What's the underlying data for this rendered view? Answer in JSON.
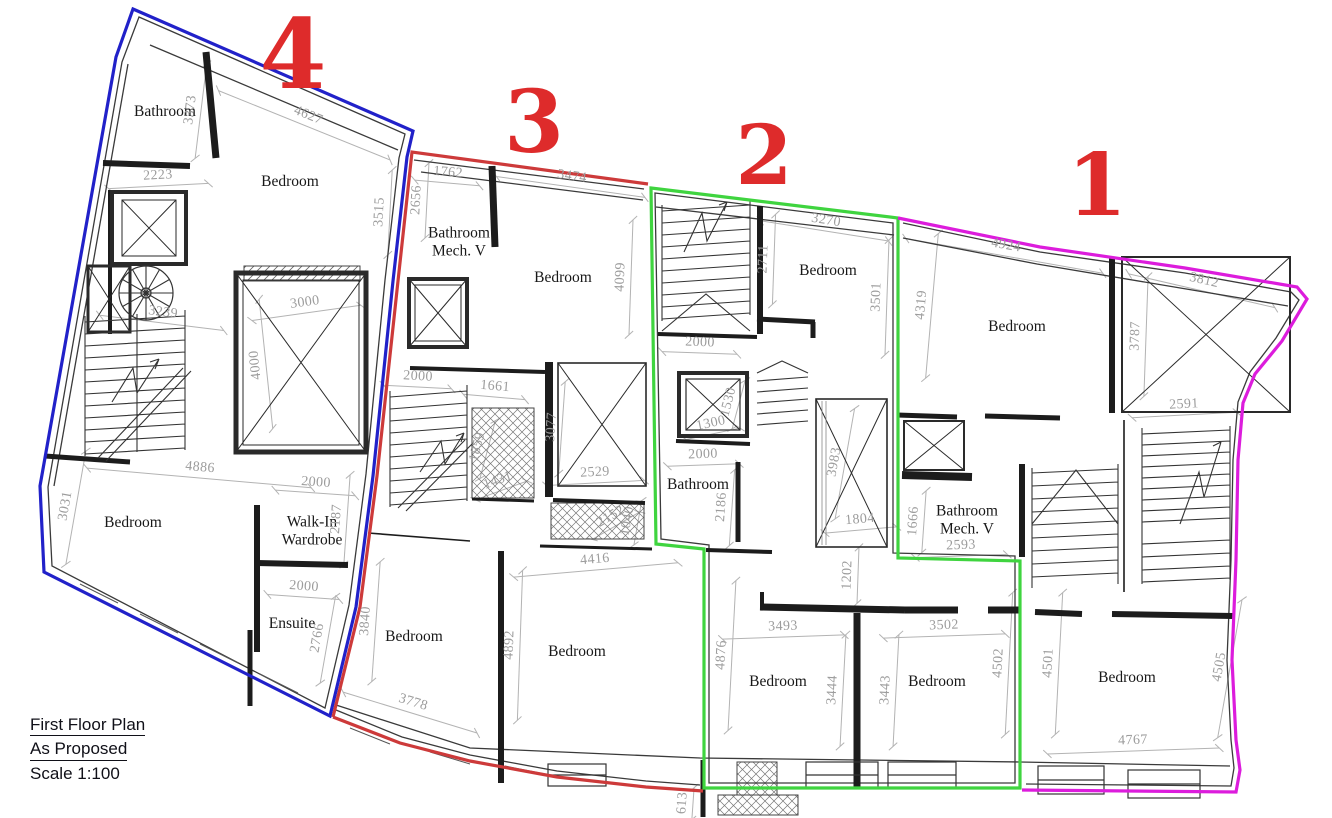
{
  "title_block": {
    "line1": "First Floor Plan",
    "line2": "As Proposed",
    "line3": "Scale 1:100"
  },
  "accent": {
    "unit_number_color": "#de2b2b",
    "dimension_text_color": "#9c9c9c",
    "wall_color": "#1c1c1c",
    "background": "#ffffff"
  },
  "units": [
    {
      "number": "4",
      "outline_color": "#2121c9",
      "label_x": 293,
      "label_y": 55,
      "size": 96
    },
    {
      "number": "3",
      "outline_color": "#cd3a3a",
      "label_x": 534,
      "label_y": 123,
      "size": 86
    },
    {
      "number": "2",
      "outline_color": "#3fd43f",
      "label_x": 764,
      "label_y": 156,
      "size": 82
    },
    {
      "number": "1",
      "outline_color": "#dc1cdc",
      "label_x": 1097,
      "label_y": 186,
      "size": 86
    }
  ],
  "rooms": [
    {
      "name": "Bathroom",
      "x": 165,
      "y": 112
    },
    {
      "name": "Bedroom",
      "x": 290,
      "y": 182
    },
    {
      "name": "Bathroom\nMech. V",
      "x": 459,
      "y": 243
    },
    {
      "name": "Bedroom",
      "x": 563,
      "y": 278
    },
    {
      "name": "Bedroom",
      "x": 828,
      "y": 271
    },
    {
      "name": "Bedroom",
      "x": 1017,
      "y": 327
    },
    {
      "name": "Bathroom",
      "x": 698,
      "y": 485
    },
    {
      "name": "Bathroom\nMech. V",
      "x": 967,
      "y": 521
    },
    {
      "name": "Bedroom",
      "x": 133,
      "y": 523
    },
    {
      "name": "Walk-In\nWardrobe",
      "x": 312,
      "y": 532
    },
    {
      "name": "Ensuite",
      "x": 292,
      "y": 624
    },
    {
      "name": "Bedroom",
      "x": 414,
      "y": 637
    },
    {
      "name": "Bedroom",
      "x": 577,
      "y": 652
    },
    {
      "name": "Bedroom",
      "x": 778,
      "y": 682
    },
    {
      "name": "Bedroom",
      "x": 937,
      "y": 682
    },
    {
      "name": "Bedroom",
      "x": 1127,
      "y": 678
    }
  ],
  "dimensions": [
    {
      "v": "3373",
      "x": 191,
      "y": 110,
      "r": -83,
      "len": 95
    },
    {
      "v": "4627",
      "x": 308,
      "y": 116,
      "r": 22,
      "len": 185
    },
    {
      "v": "2223",
      "x": 158,
      "y": 176,
      "r": -3,
      "len": 100
    },
    {
      "v": "3515",
      "x": 380,
      "y": 212,
      "r": -87,
      "len": 85
    },
    {
      "v": "2656",
      "x": 417,
      "y": 200,
      "r": -87,
      "len": 75
    },
    {
      "v": "1762",
      "x": 448,
      "y": 173,
      "r": 5,
      "len": 65
    },
    {
      "v": "3474",
      "x": 572,
      "y": 177,
      "r": 8,
      "len": 150
    },
    {
      "v": "4099",
      "x": 621,
      "y": 277,
      "r": -88,
      "len": 115
    },
    {
      "v": "3270",
      "x": 826,
      "y": 221,
      "r": 9,
      "len": 130
    },
    {
      "v": "2711",
      "x": 764,
      "y": 259,
      "r": -88,
      "len": 90
    },
    {
      "v": "3501",
      "x": 877,
      "y": 297,
      "r": -88,
      "len": 115
    },
    {
      "v": "2000",
      "x": 700,
      "y": 343,
      "r": 2,
      "len": 75
    },
    {
      "v": "4924",
      "x": 1006,
      "y": 246,
      "r": 10,
      "len": 200
    },
    {
      "v": "4319",
      "x": 922,
      "y": 305,
      "r": -85,
      "len": 145
    },
    {
      "v": "3812",
      "x": 1204,
      "y": 281,
      "r": 13,
      "len": 150
    },
    {
      "v": "3787",
      "x": 1136,
      "y": 336,
      "r": -88,
      "len": 120
    },
    {
      "v": "2591",
      "x": 1184,
      "y": 405,
      "r": -3,
      "len": 105
    },
    {
      "v": "3000",
      "x": 305,
      "y": 303,
      "r": -8,
      "len": 110
    },
    {
      "v": "4000",
      "x": 256,
      "y": 365,
      "r": -96,
      "len": 130
    },
    {
      "v": "3239",
      "x": 163,
      "y": 313,
      "r": 7,
      "len": 125
    },
    {
      "v": "4886",
      "x": 200,
      "y": 468,
      "r": 5,
      "len": 225
    },
    {
      "v": "2000",
      "x": 316,
      "y": 483,
      "r": 4,
      "len": 80
    },
    {
      "v": "3031",
      "x": 66,
      "y": 506,
      "r": -80,
      "len": 115
    },
    {
      "v": "2187",
      "x": 337,
      "y": 519,
      "r": -86,
      "len": 90
    },
    {
      "v": "2000",
      "x": 304,
      "y": 587,
      "r": 4,
      "len": 72
    },
    {
      "v": "2766",
      "x": 318,
      "y": 638,
      "r": -80,
      "len": 88
    },
    {
      "v": "3840",
      "x": 366,
      "y": 621,
      "r": -86,
      "len": 120
    },
    {
      "v": "2000",
      "x": 418,
      "y": 377,
      "r": 3,
      "len": 68
    },
    {
      "v": "1661",
      "x": 495,
      "y": 387,
      "r": 5,
      "len": 62
    },
    {
      "v": "3077",
      "x": 552,
      "y": 427,
      "r": -86,
      "len": 92
    },
    {
      "v": "2529",
      "x": 595,
      "y": 473,
      "r": -3,
      "len": 98
    },
    {
      "v": "4416",
      "x": 595,
      "y": 560,
      "r": -5,
      "len": 165
    },
    {
      "v": "1859",
      "x": 478,
      "y": 447,
      "r": -75,
      "len": 60
    },
    {
      "v": "1431",
      "x": 498,
      "y": 481,
      "r": -20,
      "len": 55
    },
    {
      "v": "2152",
      "x": 611,
      "y": 517,
      "r": -30,
      "len": 55
    },
    {
      "v": "1040",
      "x": 628,
      "y": 521,
      "r": -80,
      "len": 45
    },
    {
      "v": "1300",
      "x": 711,
      "y": 424,
      "r": -12,
      "len": 55
    },
    {
      "v": "1530",
      "x": 729,
      "y": 402,
      "r": -75,
      "len": 50
    },
    {
      "v": "2000",
      "x": 703,
      "y": 455,
      "r": -2,
      "len": 72
    },
    {
      "v": "2186",
      "x": 722,
      "y": 507,
      "r": -86,
      "len": 76
    },
    {
      "v": "3983",
      "x": 835,
      "y": 462,
      "r": -80,
      "len": 112
    },
    {
      "v": "1804",
      "x": 860,
      "y": 520,
      "r": -5,
      "len": 72
    },
    {
      "v": "1666",
      "x": 914,
      "y": 521,
      "r": -86,
      "len": 62
    },
    {
      "v": "2593",
      "x": 961,
      "y": 546,
      "r": -2,
      "len": 92
    },
    {
      "v": "1202",
      "x": 848,
      "y": 575,
      "r": -88,
      "len": 56
    },
    {
      "v": "3493",
      "x": 783,
      "y": 627,
      "r": -2,
      "len": 122
    },
    {
      "v": "4876",
      "x": 722,
      "y": 655,
      "r": -87,
      "len": 150
    },
    {
      "v": "3444",
      "x": 833,
      "y": 690,
      "r": -87,
      "len": 112
    },
    {
      "v": "3443",
      "x": 886,
      "y": 690,
      "r": -87,
      "len": 112
    },
    {
      "v": "3502",
      "x": 944,
      "y": 626,
      "r": -2,
      "len": 122
    },
    {
      "v": "4502",
      "x": 999,
      "y": 663,
      "r": -87,
      "len": 142
    },
    {
      "v": "4501",
      "x": 1049,
      "y": 663,
      "r": -87,
      "len": 142
    },
    {
      "v": "4767",
      "x": 1133,
      "y": 741,
      "r": -2,
      "len": 172
    },
    {
      "v": "4505",
      "x": 1220,
      "y": 667,
      "r": -80,
      "len": 140
    },
    {
      "v": "3778",
      "x": 413,
      "y": 703,
      "r": 17,
      "len": 140
    },
    {
      "v": "4892",
      "x": 510,
      "y": 645,
      "r": -88,
      "len": 150
    },
    {
      "v": "613",
      "x": 683,
      "y": 803,
      "r": -86,
      "len": 32
    }
  ]
}
